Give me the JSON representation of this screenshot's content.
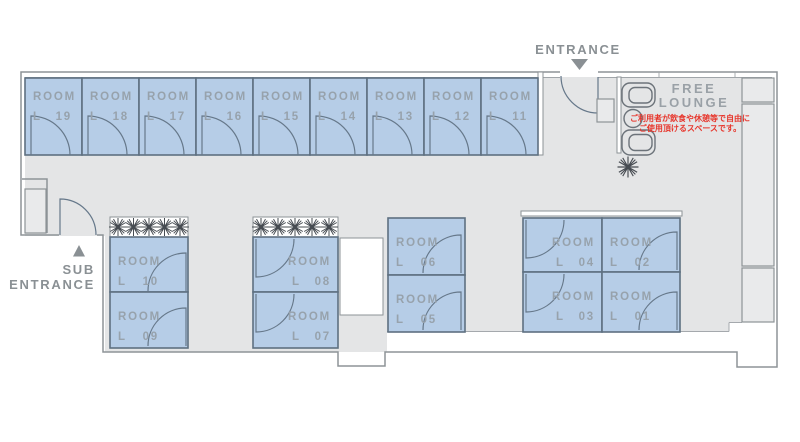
{
  "signage": {
    "entrance": "ENTRANCE",
    "sub_entrance_line1": "SUB",
    "sub_entrance_line2": "ENTRANCE",
    "free_lounge_line1": "FREE",
    "free_lounge_line2": "LOUNGE",
    "lounge_note_line1": "ご利用者が飲食や休憩等で自由に",
    "lounge_note_line2": "ご使用頂けるスペースです。"
  },
  "rooms": [
    {
      "name": "ROOM",
      "prefix": "L",
      "number": "19"
    },
    {
      "name": "ROOM",
      "prefix": "L",
      "number": "18"
    },
    {
      "name": "ROOM",
      "prefix": "L",
      "number": "17"
    },
    {
      "name": "ROOM",
      "prefix": "L",
      "number": "16"
    },
    {
      "name": "ROOM",
      "prefix": "L",
      "number": "15"
    },
    {
      "name": "ROOM",
      "prefix": "L",
      "number": "14"
    },
    {
      "name": "ROOM",
      "prefix": "L",
      "number": "13"
    },
    {
      "name": "ROOM",
      "prefix": "L",
      "number": "12"
    },
    {
      "name": "ROOM",
      "prefix": "L",
      "number": "11"
    },
    {
      "name": "ROOM",
      "prefix": "L",
      "number": "10"
    },
    {
      "name": "ROOM",
      "prefix": "L",
      "number": "09"
    },
    {
      "name": "ROOM",
      "prefix": "L",
      "number": "08"
    },
    {
      "name": "ROOM",
      "prefix": "L",
      "number": "07"
    },
    {
      "name": "ROOM",
      "prefix": "L",
      "number": "06"
    },
    {
      "name": "ROOM",
      "prefix": "L",
      "number": "05"
    },
    {
      "name": "ROOM",
      "prefix": "L",
      "number": "04"
    },
    {
      "name": "ROOM",
      "prefix": "L",
      "number": "02"
    },
    {
      "name": "ROOM",
      "prefix": "L",
      "number": "03"
    },
    {
      "name": "ROOM",
      "prefix": "L",
      "number": "01"
    }
  ],
  "colors": {
    "room_fill": "#b6cde7",
    "room_border": "#5e7081",
    "floor": "#e4e5e6",
    "wall_line": "#8d9397",
    "room_label": "#97a2ac",
    "signage_gray": "#8a9094",
    "lounge_label_gray": "#9aa1a7",
    "note_red": "#e7352b"
  }
}
